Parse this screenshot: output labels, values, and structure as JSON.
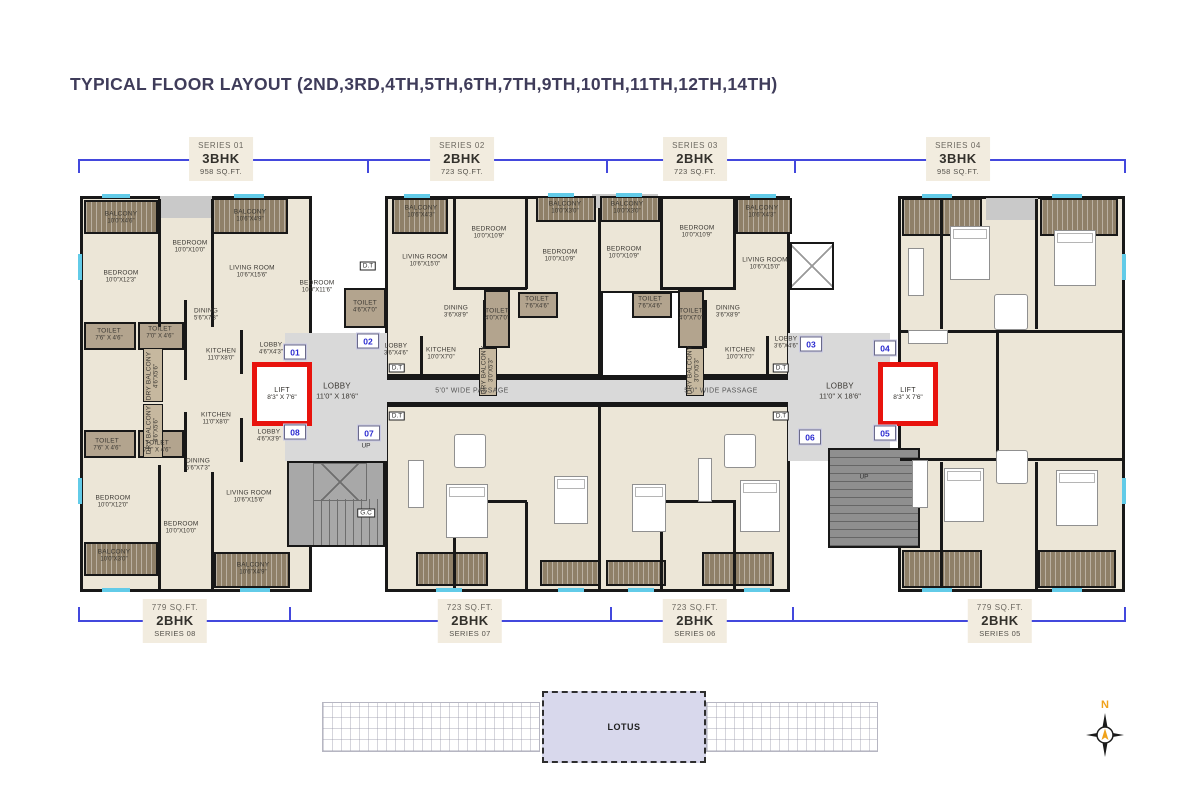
{
  "title": "TYPICAL FLOOR LAYOUT (2ND,3RD,4TH,5TH,6TH,7TH,9TH,10TH,11TH,12TH,14TH)",
  "colors": {
    "bracket_blue": "#4348dd",
    "lift_red": "#e8130d",
    "balcony_brown": "#8f8068",
    "room_beige": "#ece6d7",
    "lobby_gray": "#d9d9d9",
    "keyplan_lavender": "#d8d8ec",
    "title_color": "#3f3c5a",
    "compass_orange": "#f0a21a"
  },
  "top_series": [
    {
      "series": "SERIES 01",
      "type": "3BHK",
      "area": "958 SQ.FT."
    },
    {
      "series": "SERIES 02",
      "type": "2BHK",
      "area": "723 SQ.FT."
    },
    {
      "series": "SERIES 03",
      "type": "2BHK",
      "area": "723 SQ.FT."
    },
    {
      "series": "SERIES 04",
      "type": "3BHK",
      "area": "958 SQ.FT."
    }
  ],
  "bottom_series": [
    {
      "area": "779 SQ.FT.",
      "type": "2BHK",
      "series": "SERIES 08"
    },
    {
      "area": "723 SQ.FT.",
      "type": "2BHK",
      "series": "SERIES 07"
    },
    {
      "area": "723 SQ.FT.",
      "type": "2BHK",
      "series": "SERIES 06"
    },
    {
      "area": "779 SQ.FT.",
      "type": "2BHK",
      "series": "SERIES 05"
    }
  ],
  "plan": {
    "passage_label": "5'0\" WIDE PASSAGE",
    "passage_positions": [
      [
        472,
        391
      ],
      [
        721,
        391
      ]
    ],
    "lift": {
      "name": "LIFT",
      "dims": "8'3\" X 7'6\""
    },
    "main_lobby": {
      "name": "LOBBY",
      "dims": "11'0\" X 18'6\""
    },
    "main_lobby_positions": [
      [
        337,
        391
      ],
      [
        840,
        391
      ]
    ],
    "units": [
      {
        "n": "01",
        "x": 295,
        "y": 352
      },
      {
        "n": "02",
        "x": 368,
        "y": 341
      },
      {
        "n": "03",
        "x": 811,
        "y": 344
      },
      {
        "n": "04",
        "x": 885,
        "y": 348
      },
      {
        "n": "05",
        "x": 885,
        "y": 433
      },
      {
        "n": "06",
        "x": 810,
        "y": 437
      },
      {
        "n": "07",
        "x": 369,
        "y": 433
      },
      {
        "n": "08",
        "x": 295,
        "y": 432
      }
    ],
    "rooms": [
      {
        "n": "BALCONY",
        "d": "10'0\"X4'6\"",
        "x": 121,
        "y": 218
      },
      {
        "n": "BEDROOM",
        "d": "10'0\"X10'0\"",
        "x": 190,
        "y": 247
      },
      {
        "n": "BALCONY",
        "d": "10'6\"X4'9\"",
        "x": 250,
        "y": 216
      },
      {
        "n": "BEDROOM",
        "d": "10'0\"X12'3\"",
        "x": 121,
        "y": 277
      },
      {
        "n": "LIVING ROOM",
        "d": "10'6\"X15'6\"",
        "x": 252,
        "y": 272
      },
      {
        "n": "BEDROOM",
        "d": "10'0\"X11'6\"",
        "x": 317,
        "y": 287
      },
      {
        "n": "TOILET",
        "d": "7'6\" X 4'6\"",
        "x": 109,
        "y": 335
      },
      {
        "n": "TOILET",
        "d": "7'0\" X 4'6\"",
        "x": 160,
        "y": 333
      },
      {
        "n": "DINING",
        "d": "5'6\"X7'3\"",
        "x": 206,
        "y": 315
      },
      {
        "n": "TOILET",
        "d": "4'6\"X7'0\"",
        "x": 365,
        "y": 307
      },
      {
        "n": "KITCHEN",
        "d": "11'0\"X8'0\"",
        "x": 221,
        "y": 355
      },
      {
        "n": "DRY BALCONY",
        "d": "4'6\"X5'6\"",
        "x": 153,
        "y": 376,
        "v": 1
      },
      {
        "n": "LOBBY",
        "d": "4'6\"X4'3\"",
        "x": 271,
        "y": 349
      },
      {
        "n": "LOBBY",
        "d": "4'6\"X3'9\"",
        "x": 269,
        "y": 436
      },
      {
        "n": "BALCONY",
        "d": "10'6\"X4'3\"",
        "x": 421,
        "y": 212
      },
      {
        "n": "BEDROOM",
        "d": "10'0\"X10'9\"",
        "x": 489,
        "y": 233
      },
      {
        "n": "BALCONY",
        "d": "10'0\"X3'0\"",
        "x": 565,
        "y": 208
      },
      {
        "n": "LIVING ROOM",
        "d": "10'6\"X15'0\"",
        "x": 425,
        "y": 261
      },
      {
        "n": "BEDROOM",
        "d": "10'0\"X10'9\"",
        "x": 560,
        "y": 256
      },
      {
        "n": "DINING",
        "d": "3'6\"X8'9\"",
        "x": 456,
        "y": 312
      },
      {
        "n": "TOILET",
        "d": "4'0\"X7'0\"",
        "x": 497,
        "y": 315
      },
      {
        "n": "TOILET",
        "d": "7'6\"X4'6\"",
        "x": 537,
        "y": 303
      },
      {
        "n": "LOBBY",
        "d": "3'6\"X4'6\"",
        "x": 396,
        "y": 350
      },
      {
        "n": "KITCHEN",
        "d": "10'0\"X7'0\"",
        "x": 441,
        "y": 354
      },
      {
        "n": "DRY BALCONY",
        "d": "3'0\"X5'3\"",
        "x": 488,
        "y": 370,
        "v": 1
      },
      {
        "n": "BALCONY",
        "d": "10'0\"X3'0\"",
        "x": 627,
        "y": 208
      },
      {
        "n": "BEDROOM",
        "d": "10'0\"X10'9\"",
        "x": 697,
        "y": 232
      },
      {
        "n": "BALCONY",
        "d": "10'6\"X4'3\"",
        "x": 762,
        "y": 212
      },
      {
        "n": "BEDROOM",
        "d": "10'0\"X10'9\"",
        "x": 624,
        "y": 253
      },
      {
        "n": "LIVING ROOM",
        "d": "10'6\"X15'0\"",
        "x": 765,
        "y": 264
      },
      {
        "n": "TOILET",
        "d": "7'6\"X4'6\"",
        "x": 650,
        "y": 303
      },
      {
        "n": "TOILET",
        "d": "4'0\"X7'0\"",
        "x": 691,
        "y": 315
      },
      {
        "n": "DINING",
        "d": "3'6\"X8'9\"",
        "x": 728,
        "y": 312
      },
      {
        "n": "KITCHEN",
        "d": "10'0\"X7'0\"",
        "x": 740,
        "y": 354
      },
      {
        "n": "LOBBY",
        "d": "3'6\"X4'6\"",
        "x": 786,
        "y": 343
      },
      {
        "n": "DRY BALCONY",
        "d": "3'0\"X5'3\"",
        "x": 694,
        "y": 370,
        "v": 1
      },
      {
        "n": "KITCHEN",
        "d": "11'0\"X8'0\"",
        "x": 216,
        "y": 419
      },
      {
        "n": "TOILET",
        "d": "7'6\" X 4'6\"",
        "x": 107,
        "y": 445
      },
      {
        "n": "TOILET",
        "d": "7'0\" X 4'6\"",
        "x": 157,
        "y": 447
      },
      {
        "n": "DINING",
        "d": "5'6\"X7'3\"",
        "x": 198,
        "y": 465
      },
      {
        "n": "BEDROOM",
        "d": "10'0\"X12'0\"",
        "x": 113,
        "y": 502
      },
      {
        "n": "LIVING ROOM",
        "d": "10'6\"X15'6\"",
        "x": 249,
        "y": 497
      },
      {
        "n": "BEDROOM",
        "d": "10'0\"X10'0\"",
        "x": 181,
        "y": 528
      },
      {
        "n": "BALCONY",
        "d": "10'0\"X3'0\"",
        "x": 114,
        "y": 556
      },
      {
        "n": "BALCONY",
        "d": "10'6\"X4'9\"",
        "x": 253,
        "y": 569
      },
      {
        "n": "DRY BALCONY",
        "d": "4'6\"X5'6\"",
        "x": 153,
        "y": 430,
        "v": 1
      }
    ],
    "small_labels": [
      {
        "t": "D.T",
        "x": 368,
        "y": 266,
        "b": 1
      },
      {
        "t": "D.T",
        "x": 397,
        "y": 368,
        "b": 1
      },
      {
        "t": "D.T",
        "x": 397,
        "y": 416,
        "b": 1
      },
      {
        "t": "D.T",
        "x": 781,
        "y": 368,
        "b": 1
      },
      {
        "t": "D.T",
        "x": 781,
        "y": 416,
        "b": 1
      },
      {
        "t": "UP",
        "x": 366,
        "y": 446
      },
      {
        "t": "UP",
        "x": 864,
        "y": 477
      },
      {
        "t": "G.C",
        "x": 366,
        "y": 513,
        "b": 1
      }
    ]
  },
  "keyplan": {
    "label": "LOTUS"
  },
  "compass": {
    "label": "N"
  }
}
